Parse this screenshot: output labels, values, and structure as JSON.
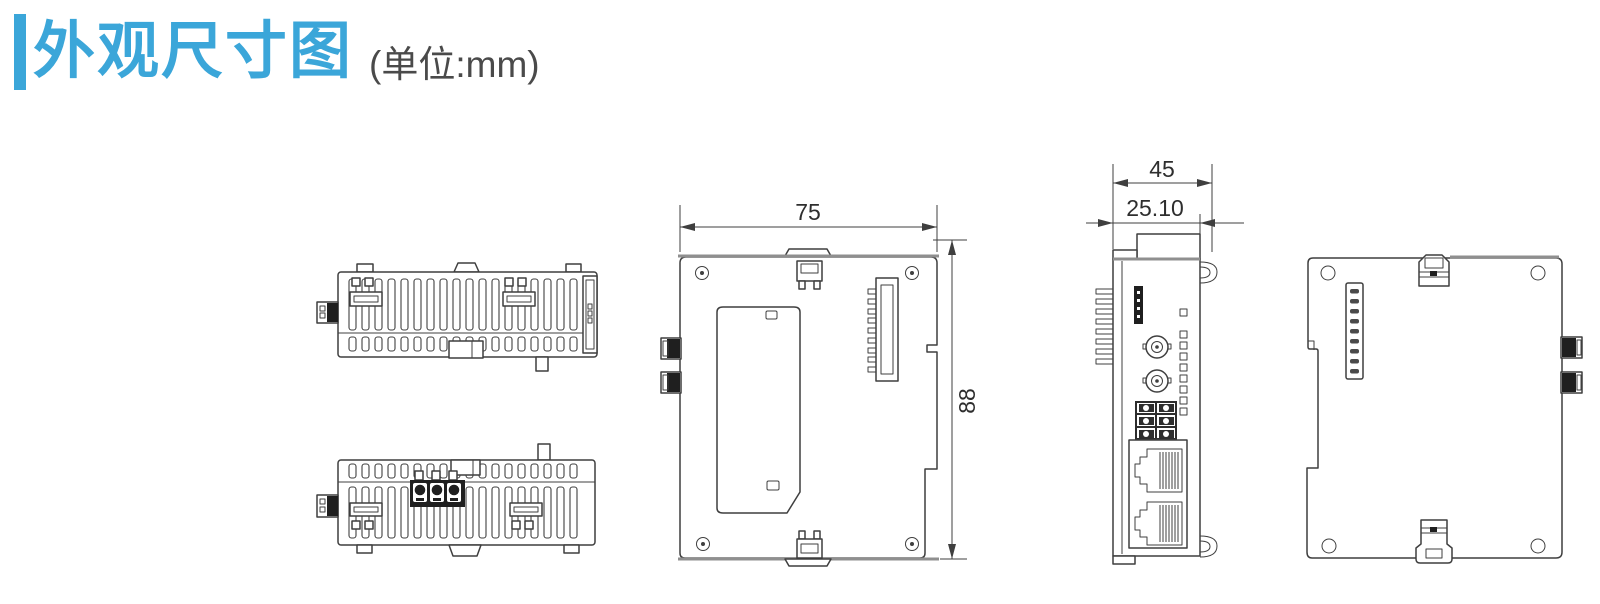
{
  "header": {
    "title": "外观尺寸图",
    "unit_label": "(单位:mm)"
  },
  "dimensions": {
    "front_width_mm": "75",
    "front_height_mm": "88",
    "side_depth_mm": "45",
    "side_front_depth_mm": "25.10"
  },
  "colors": {
    "title_blue": "#3ba6d9",
    "unit_gray": "#4a4a4a",
    "line_dark": "#3f3f3f",
    "edge_gray": "#8f8f8f",
    "background": "#ffffff"
  }
}
